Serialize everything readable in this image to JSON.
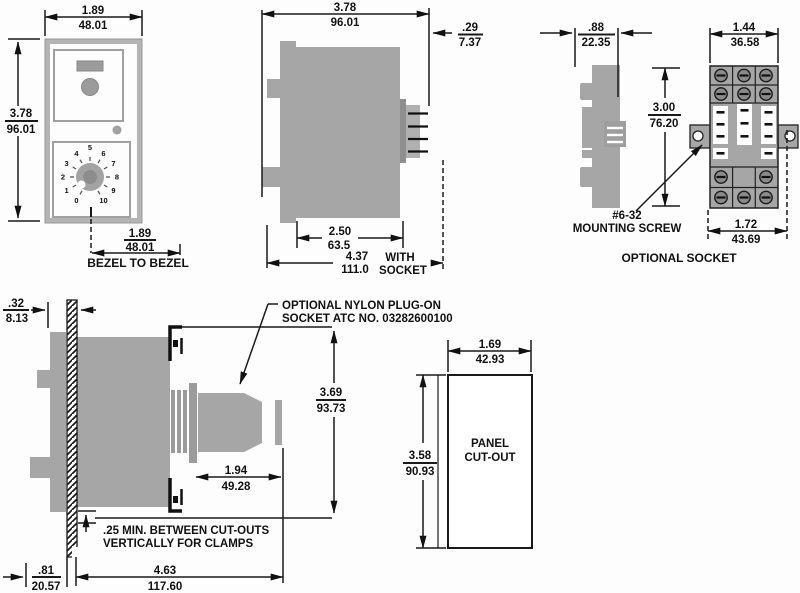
{
  "drawing": {
    "front_view": {
      "width": {
        "in": "1.89",
        "mm": "48.01"
      },
      "height": {
        "in": "3.78",
        "mm": "96.01"
      },
      "bezel": {
        "in": "1.89",
        "mm": "48.01"
      },
      "bezel_label": "BEZEL TO BEZEL",
      "dial": {
        "labels": [
          "0",
          "1",
          "2",
          "3",
          "4",
          "5",
          "6",
          "7",
          "8",
          "9",
          "10"
        ]
      }
    },
    "side_view": {
      "depth": {
        "in": "3.78",
        "mm": "96.01"
      },
      "pin": {
        "in": ".29",
        "mm": "7.37"
      },
      "case": {
        "in": "2.50",
        "mm": "63.5"
      },
      "total": {
        "in": "4.37",
        "mm": "111.0"
      },
      "total_note_1": "WITH",
      "total_note_2": "SOCKET"
    },
    "socket_view": {
      "depth": {
        "in": ".88",
        "mm": "22.35"
      },
      "width": {
        "in": "1.44",
        "mm": "36.58"
      },
      "height": {
        "in": "3.00",
        "mm": "76.20"
      },
      "mounting_centers": {
        "in": "1.72",
        "mm": "43.69"
      },
      "screw_note_1": "#6-32",
      "screw_note_2": "MOUNTING SCREW",
      "title": "OPTIONAL SOCKET"
    },
    "mounting_view": {
      "panel": {
        "in": ".32",
        "mm": "8.13"
      },
      "socket_note_1": "OPTIONAL NYLON PLUG-ON",
      "socket_note_2": "SOCKET ATC NO. 03282600100",
      "height": {
        "in": "3.69",
        "mm": "93.73"
      },
      "socket_length": {
        "in": "1.94",
        "mm": "49.28"
      },
      "clamp_note_1": ".25 MIN. BETWEEN CUT-OUTS",
      "clamp_note_2": "VERTICALLY FOR CLAMPS",
      "offset": {
        "in": ".81",
        "mm": "20.57"
      },
      "total": {
        "in": "4.63",
        "mm": "117.60"
      }
    },
    "cutout_view": {
      "width": {
        "in": "1.69",
        "mm": "42.93"
      },
      "height": {
        "in": "3.58",
        "mm": "90.93"
      },
      "label_1": "PANEL",
      "label_2": "CUT-OUT"
    }
  }
}
